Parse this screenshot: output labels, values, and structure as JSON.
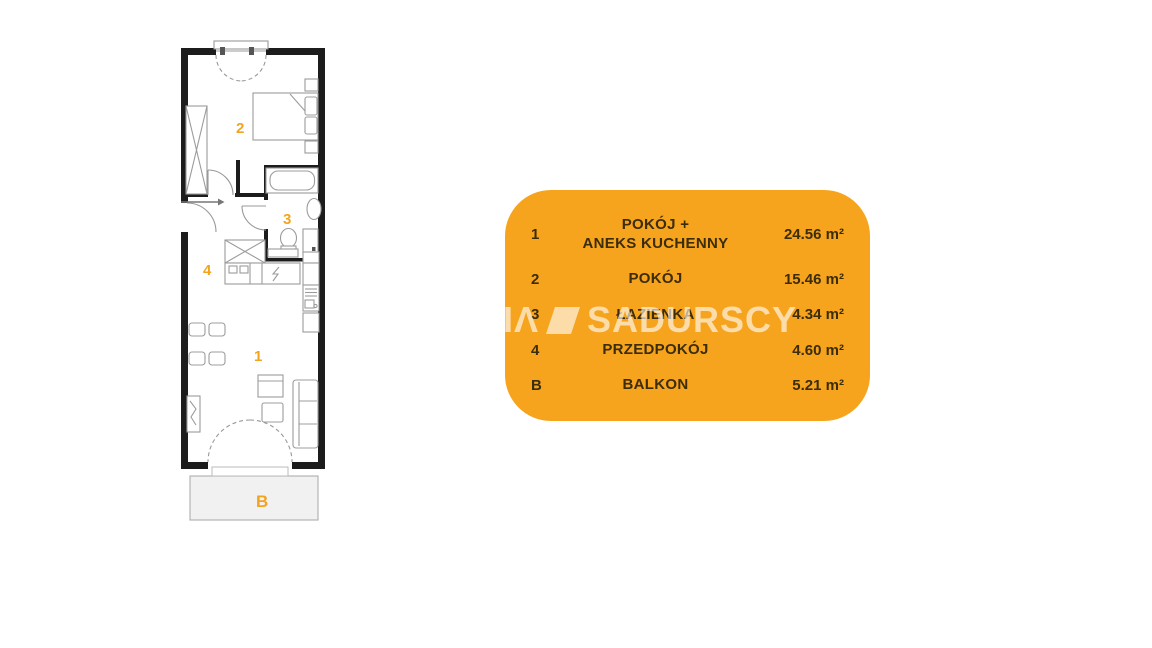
{
  "plan": {
    "labels": {
      "living": "1",
      "bedroom": "2",
      "bathroom": "3",
      "hall": "4",
      "balcony": "B"
    }
  },
  "legend": {
    "rows": [
      {
        "no": "1",
        "name": "POKÓJ +\nANEKS KUCHENNY",
        "area": "24.56 m²"
      },
      {
        "no": "2",
        "name": "POKÓJ",
        "area": "15.46 m²"
      },
      {
        "no": "3",
        "name": "ŁAZIENKA",
        "area": "4.34 m²"
      },
      {
        "no": "4",
        "name": "PRZEDPOKÓJ",
        "area": "4.60 m²"
      },
      {
        "no": "B",
        "name": "BALKON",
        "area": "5.21 m²"
      }
    ]
  },
  "watermark": {
    "prefix": "IΛ",
    "text": "SADURSCY"
  },
  "colors": {
    "accent_orange": "#F6A41E",
    "legend_text": "#3C2C08",
    "wall_black": "#1c1c1c",
    "furniture_gray": "#9c9c9c",
    "balcony_fill": "#f1f1f1",
    "watermark_white": "rgba(255,255,255,0.62)"
  }
}
